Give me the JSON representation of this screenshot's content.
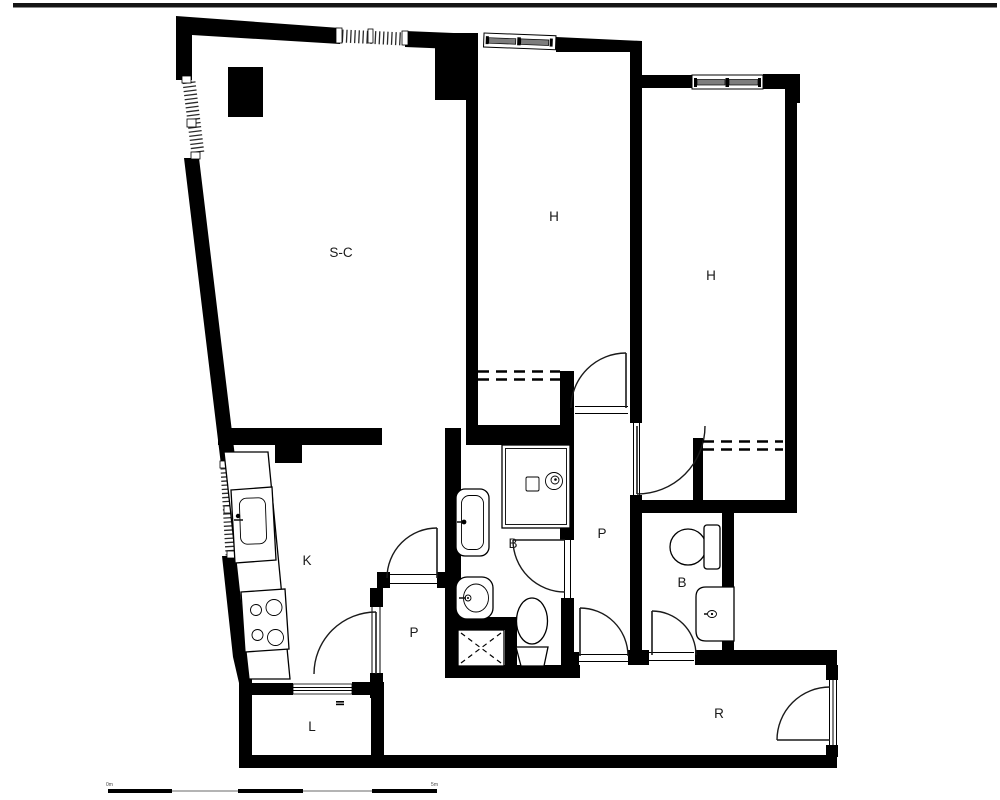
{
  "rooms": {
    "living": {
      "label": "S-C"
    },
    "bedroom_center": {
      "label": "H"
    },
    "bedroom_right": {
      "label": "H"
    },
    "kitchen": {
      "label": "K"
    },
    "hall_center": {
      "label": "P"
    },
    "hall_kitchen": {
      "label": "P"
    },
    "bath_main": {
      "label": "B"
    },
    "bath_second": {
      "label": "B"
    },
    "laundry": {
      "label": "L"
    },
    "entry": {
      "label": "R"
    }
  },
  "scale_bar": {
    "left_label": "0m",
    "right_label": "5m"
  },
  "colors": {
    "wall": "#000000",
    "background": "#ffffff",
    "label": "#1a1a1a",
    "top_rule": "#151515"
  }
}
